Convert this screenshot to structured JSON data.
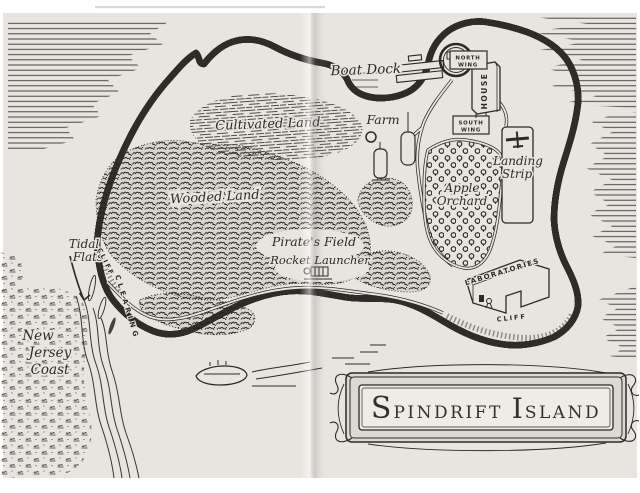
{
  "page": {
    "kind": "scanned-book-map-page"
  },
  "colors": {
    "ink": "#2b2a27",
    "paper": "#e8e5e0",
    "panel": "#eeece7"
  },
  "cartouche": {
    "full_title": "Spindrift Island",
    "t1": "S",
    "t2": "PINDRIFT",
    "t3": "I",
    "t4": "SLAND"
  },
  "labels": {
    "boat_dock": "Boat Dock",
    "farm": "Farm",
    "cultivated_land": "Cultivated Land",
    "wooded_land": "Wooded Land",
    "tidal_flats_line1": "Tidal",
    "tidal_flats_line2": "Flats",
    "cliff_west": "CLIFF",
    "clearing": "CLEARING",
    "pirates_field": "Pirate's Field",
    "rocket_launcher": "Rocket Launcher",
    "apple_orchard_line1": "Apple",
    "apple_orchard_line2": "Orchard",
    "new_jersey_line1": "New",
    "new_jersey_line2": "Jersey",
    "new_jersey_line3": "Coast",
    "laboratories": "LABORATORIES",
    "cliff_south": "CLIFF",
    "landing_strip_line1": "Landing",
    "landing_strip_line2": "Strip",
    "north_wing_line1": "NORTH",
    "north_wing_line2": "WING",
    "south_wing_line1": "SOUTH",
    "south_wing_line2": "WING",
    "house": "HOUSE"
  }
}
